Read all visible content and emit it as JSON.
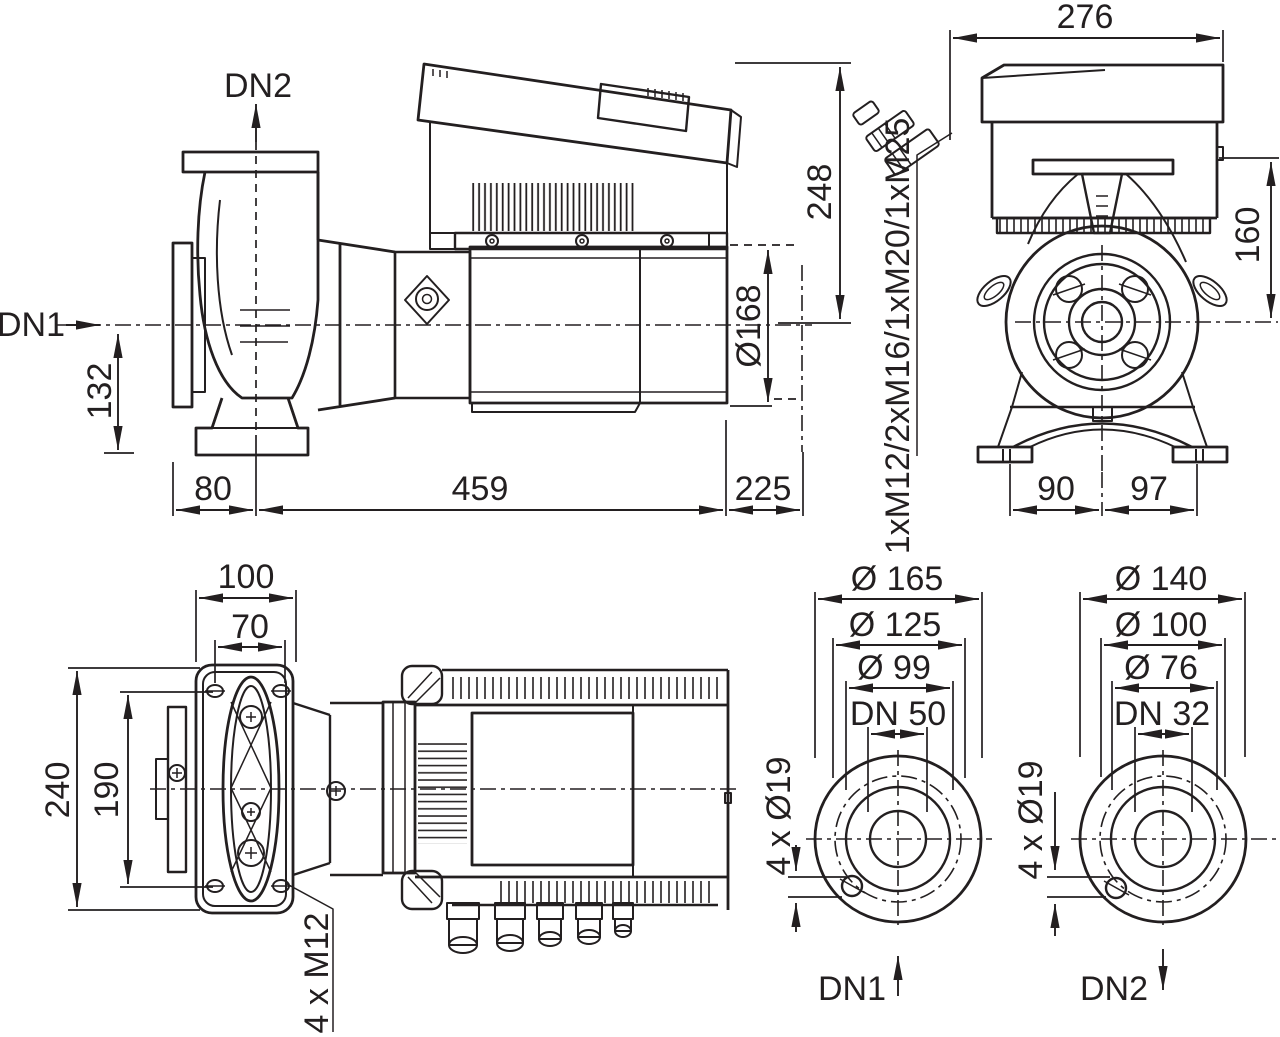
{
  "side_view": {
    "port_in_label": "DN1",
    "port_out_label": "DN2",
    "dim_center_height": "132",
    "dim_flange_to_axis": "80",
    "dim_main_length": "459",
    "dim_rear_length": "225",
    "dim_height_above_axis": "248",
    "dim_motor_diameter": "Ø168",
    "cable_gland_label": "1xM12/2xM16/1xM20/1xM25"
  },
  "end_view": {
    "dim_width": "276",
    "dim_height": "160",
    "dim_foot_left": "90",
    "dim_foot_right": "97"
  },
  "plan_view": {
    "dim_plate_width": "100",
    "dim_slot_spacing_x": "70",
    "dim_plate_length": "240",
    "dim_slot_spacing_y": "190",
    "foot_bolts_label": "4 x M12"
  },
  "flange_dn1": {
    "dim_outer": "Ø 165",
    "dim_bolt_circle": "Ø 125",
    "dim_face": "Ø 99",
    "dim_nominal": "DN 50",
    "bolt_holes_label": "4 x Ø19",
    "port_label": "DN1"
  },
  "flange_dn2": {
    "dim_outer": "Ø 140",
    "dim_bolt_circle": "Ø 100",
    "dim_face": "Ø 76",
    "dim_nominal": "DN 32",
    "bolt_holes_label": "4 x Ø19",
    "port_label": "DN2"
  },
  "line_color": "#231f20"
}
